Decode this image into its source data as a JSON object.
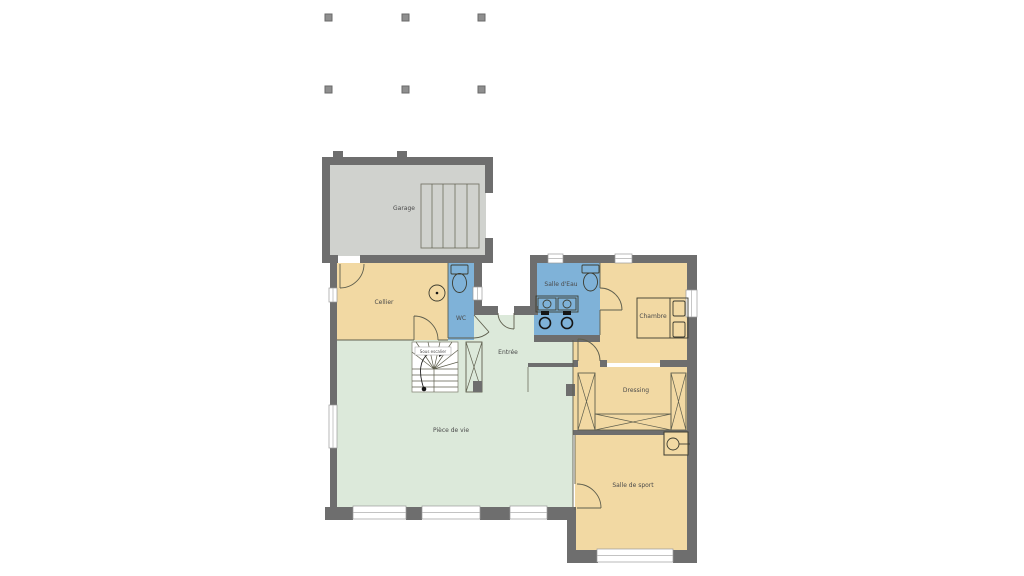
{
  "plan": {
    "type": "house-ground-floor-plan",
    "rooms": {
      "garage": {
        "label": "Garage"
      },
      "cellier": {
        "label": "Cellier"
      },
      "wc": {
        "label": "WC"
      },
      "salle_deau": {
        "label": "Salle d'Eau"
      },
      "chambre": {
        "label": "Chambre"
      },
      "entree": {
        "label": "Entrée"
      },
      "sous_escalier": {
        "label": "Sous escalier"
      },
      "piece_de_vie": {
        "label": "Pièce de vie"
      },
      "dressing": {
        "label": "Dressing"
      },
      "salle_de_sport": {
        "label": "Salle de sport"
      }
    },
    "fixtures": [
      "staircase",
      "entry-closet",
      "wardrobes",
      "bed",
      "toilet-wc",
      "toilet-salle-deau",
      "double-sink-vanity",
      "floor-drain",
      "water-heater",
      "garage-door",
      "exterior-posts"
    ],
    "colors": {
      "wall": "#6e6e6e",
      "garage_floor": "#d0d2ce",
      "warm_room": "#f2d9a3",
      "wet_room": "#7fb2d8",
      "living_room": "#dce9da",
      "outline": "#5f5f4e",
      "label_text": "#4a4a4a",
      "background": "#ffffff"
    }
  }
}
